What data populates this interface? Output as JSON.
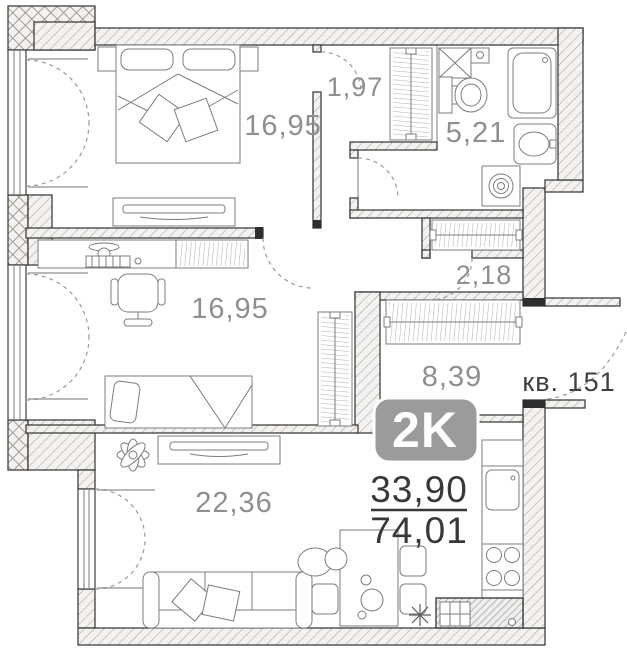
{
  "plan": {
    "badge": "2K",
    "area_living": "33,90",
    "area_total": "74,01",
    "apartment": "кв. 151",
    "rooms": {
      "bedroom1": "16,95",
      "bedroom2": "16,95",
      "vestibule": "1,97",
      "bathroom": "5,21",
      "closet": "2,18",
      "hallway": "8,39",
      "living": "22,36"
    },
    "icons": {
      "snowflake": "✳",
      "double-bed": "top-left bedroom",
      "single-bed": "second bedroom",
      "desk-with-chair": "second bedroom",
      "wardrobes": 4,
      "bathtub-toilet-sink-washing-machine": "bathroom",
      "sofa-tv-plant-dining-table": "living room",
      "kitchen-sink-stove": "kitchen"
    },
    "colors": {
      "label_gray": "#8f8f8f",
      "dark_text": "#3f3f3f",
      "badge_bg": "#9b9b9b",
      "badge_border": "#ffffff",
      "wall_hatch": "#a39a92",
      "floor": "#ffffff"
    }
  }
}
